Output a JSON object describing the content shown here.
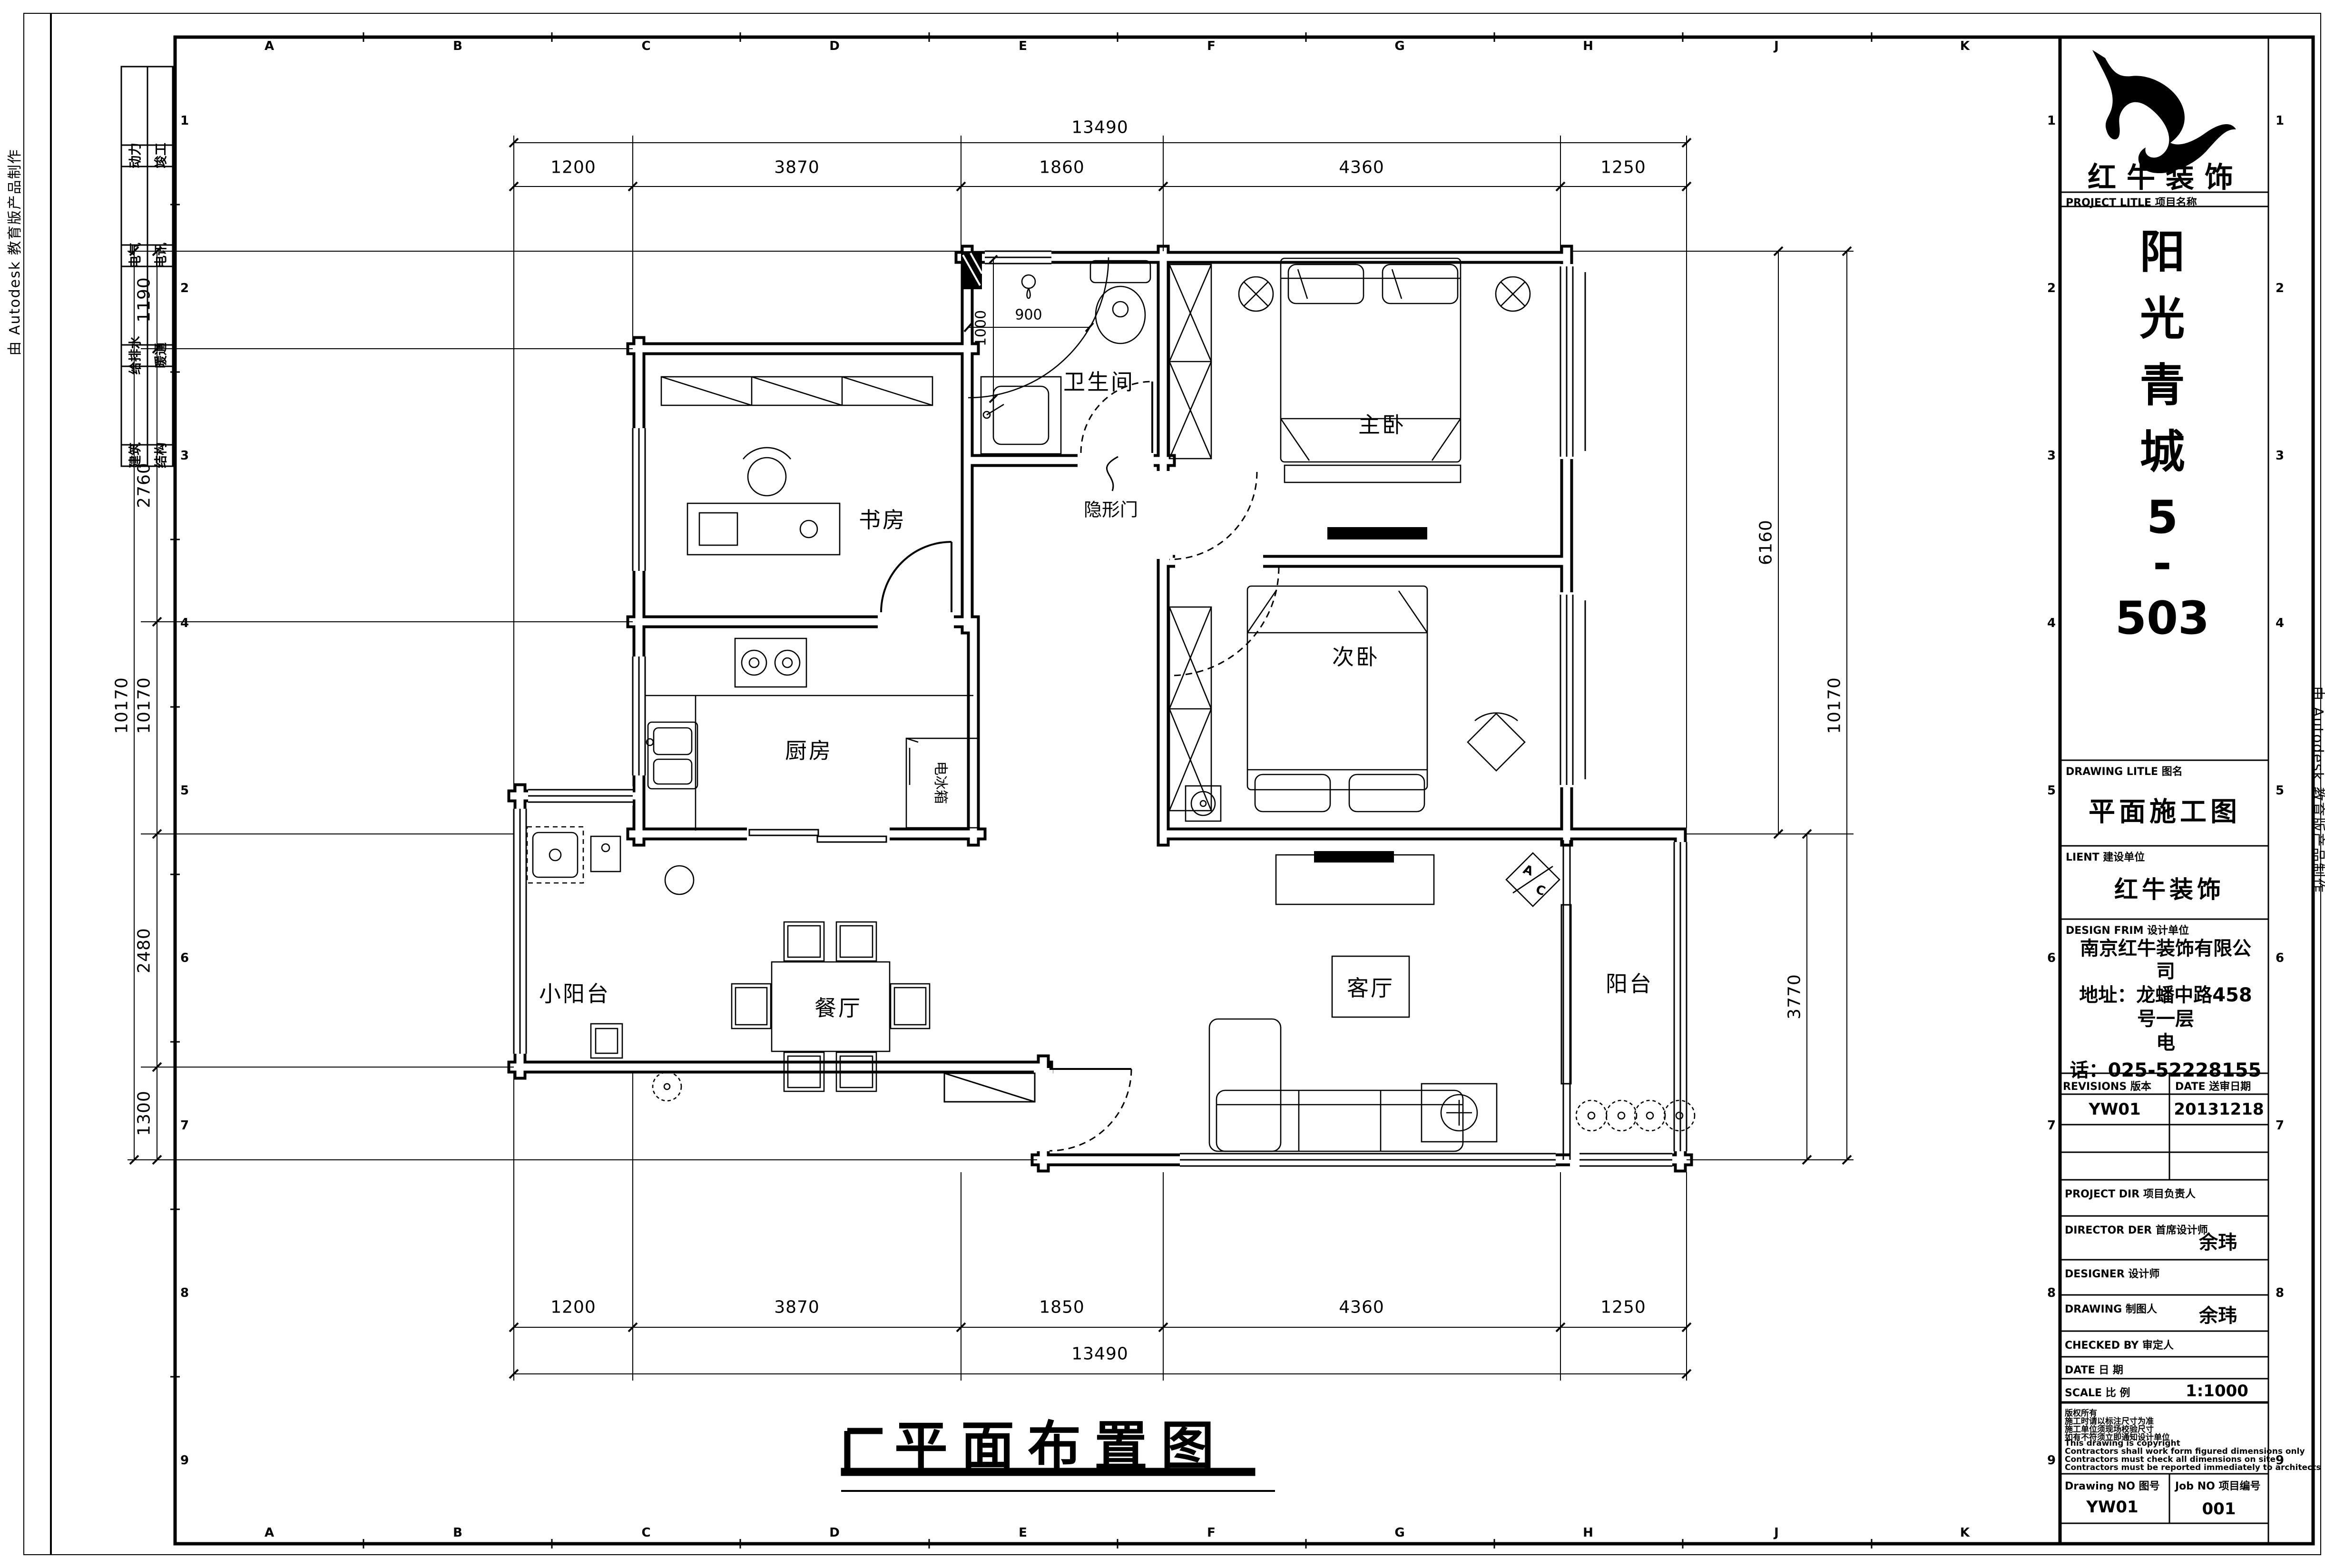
{
  "page": {
    "bg": "#ffffff",
    "ink": "#000000"
  },
  "edge_note_left": "由 Autodesk 教育版产品制作",
  "edge_note_right": "由 Autodesk 教育版产品制作",
  "grid": {
    "cols": [
      "A",
      "B",
      "C",
      "D",
      "E",
      "F",
      "G",
      "H",
      "J",
      "K"
    ],
    "rows": [
      "1",
      "2",
      "3",
      "4",
      "5",
      "6",
      "7",
      "8",
      "9"
    ]
  },
  "stamps": {
    "r1l": "动力",
    "r1r": "竣工",
    "r2l": "电气",
    "r2r": "电讯",
    "r3l": "给排水",
    "r3r": "暖通",
    "r4l": "建筑",
    "r4r": "结构"
  },
  "rooms": {
    "study": "书房",
    "kitchen": "厨房",
    "fridge": "电冰箱",
    "dining": "餐厅",
    "small_balcony": "小阳台",
    "bath": "卫生间",
    "hidden_door": "隐形门",
    "master": "主卧",
    "second": "次卧",
    "living": "客厅",
    "balcony": "阳台",
    "ac_a": "A",
    "ac_c": "C"
  },
  "dims": {
    "top_overall": "13490",
    "top": [
      "1200",
      "3870",
      "1860",
      "4360",
      "1250"
    ],
    "bottom": [
      "1200",
      "3870",
      "1850",
      "4360",
      "1250"
    ],
    "bottom_overall": "13490",
    "left_overall": "10170",
    "left_overall_inner": "10170",
    "left": [
      "1190",
      "2760",
      "2480",
      "1300"
    ],
    "right_upper": "6160",
    "right_overall": "10170",
    "right_lower": "3770",
    "bath_w": "900",
    "bath_d": "1000"
  },
  "plan_title": "平面布置图",
  "title_block": {
    "brand": "红牛装饰",
    "project_label": "PROJECT LITLE 项目名称",
    "project_chars": [
      "阳",
      "光",
      "青",
      "城",
      "5",
      "-",
      "503"
    ],
    "drawing_title_label": "DRAWING LITLE 图名",
    "drawing_title": "平面施工图",
    "client_label": "LIENT 建设单位",
    "client": "红牛装饰",
    "design_firm_label": "DESIGN FRIM 设计单位",
    "design_firm_lines": [
      "南京红牛装饰有限公",
      "司",
      "地址：龙蟠中路458",
      "号一层",
      "电",
      "话：025-52228155"
    ],
    "revisions_label": "REVISIONS 版本",
    "revisions_date_label": "DATE 送审日期",
    "revision_no": "YW01",
    "revision_date": "20131218",
    "project_dir_label": "PROJECT DIR 项目负责人",
    "director_label": "DIRECTOR DER 首席设计师",
    "director": "余玮",
    "designer_label": "DESIGNER 设计师",
    "drawing_by_label": "DRAWING 制图人",
    "drawing_by": "余玮",
    "checked_label": "CHECKED BY 审定人",
    "date_label": "DATE 日 期",
    "scale_label": "SCALE 比 例",
    "scale": "1:1000",
    "copyright_lines": [
      "版权所有",
      "施工时请以标注尺寸为准",
      "施工单位须现场校验尺寸",
      "如有不符须立即通知设计单位",
      "This drawing is copyright",
      "Contractors shall work form figured dimensions only",
      "Contractors must check all dimensions on site",
      "Contractors must be reported immediately to architects"
    ],
    "drawing_no_label": "Drawing NO 图号",
    "drawing_no": "YW01",
    "job_no_label": "Job NO 项目编号",
    "job_no": "001"
  }
}
